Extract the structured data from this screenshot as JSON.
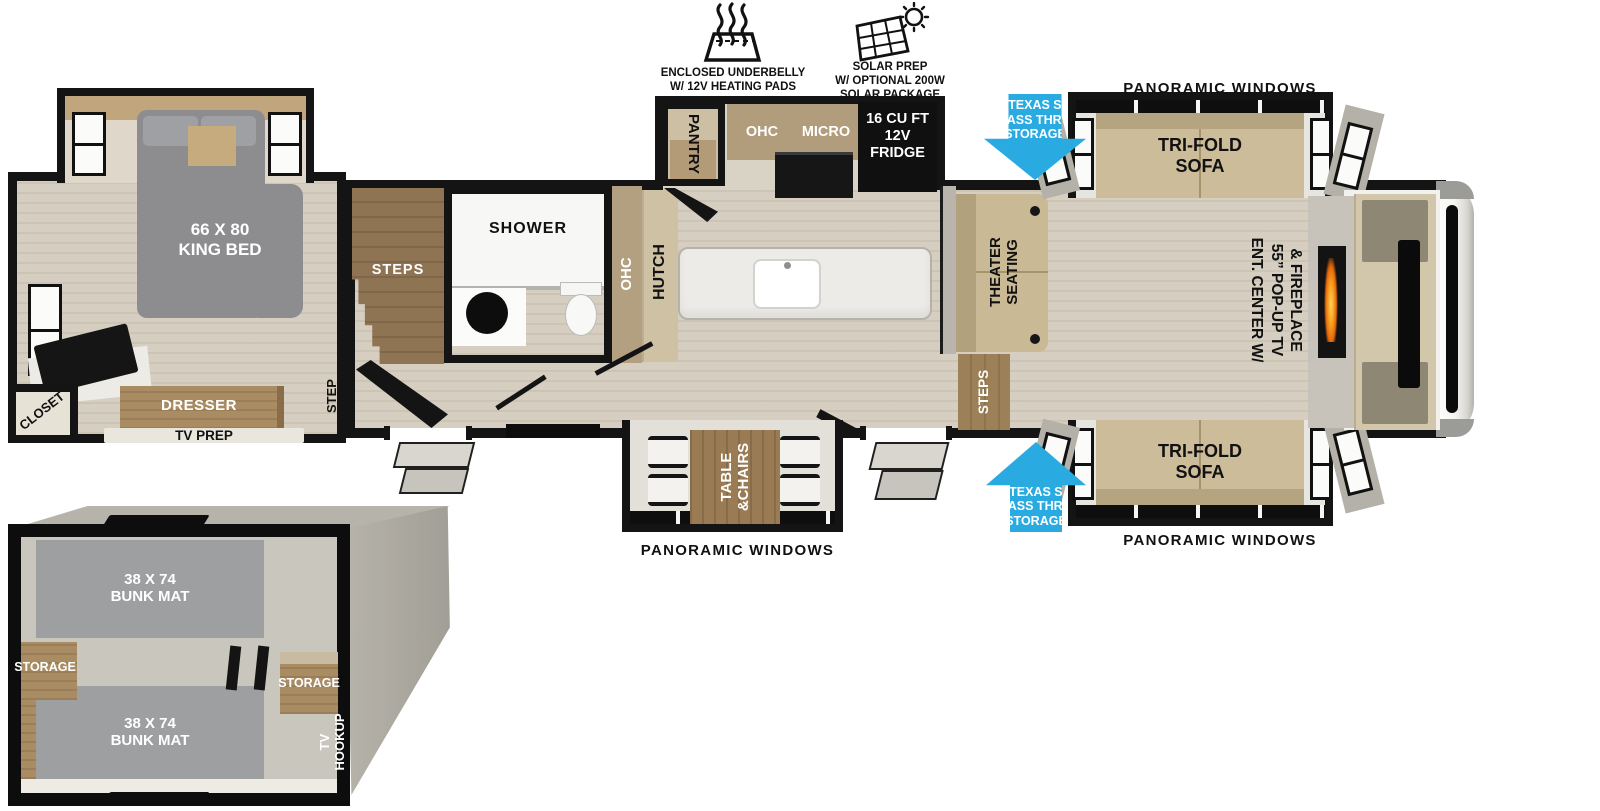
{
  "features": {
    "underbelly": {
      "line1": "ENCLOSED UNDERBELLY",
      "line2": "W/ 12V HEATING PADS"
    },
    "solar": {
      "line1": "SOLAR PREP",
      "line2": "W/ OPTIONAL 200W",
      "line3": "SOLAR PACKAGE"
    }
  },
  "windows": {
    "top": "PANORAMIC WINDOWS",
    "bottom_right": "PANORAMIC WINDOWS",
    "bottom_center": "PANORAMIC WINDOWS"
  },
  "pass_thru": {
    "line1": "XL TEXAS SIZE",
    "line2": "PASS THRU",
    "line3": "STORAGE"
  },
  "bedroom": {
    "bed_line1": "66 X 80",
    "bed_line2": "KING BED",
    "closet": "CLOSET",
    "dresser": "DRESSER",
    "tv_prep": "TV PREP",
    "step": "STEP",
    "steps": "STEPS"
  },
  "bathroom": {
    "shower": "SHOWER",
    "ohc": "OHC"
  },
  "kitchen": {
    "pantry": "PANTRY",
    "ohc": "OHC",
    "micro": "MICRO",
    "hutch": "HUTCH",
    "fridge_line1": "16 CU FT",
    "fridge_line2": "12V",
    "fridge_line3": "FRIDGE"
  },
  "living": {
    "theater_line1": "THEATER",
    "theater_line2": "SEATING",
    "steps": "STEPS",
    "sofa_line1": "TRI-FOLD",
    "sofa_line2": "SOFA",
    "ent_line1": "ENT. CENTER W/",
    "ent_line2": "55” POP-UP TV",
    "ent_line3": "& FIREPLACE"
  },
  "dinette": {
    "line1": "TABLE",
    "line2": "&CHAIRS"
  },
  "bunkroom": {
    "bunk_line1": "38 X 74",
    "bunk_line2": "BUNK MAT",
    "storage": "STORAGE",
    "tv_line1": "TV",
    "tv_line2": "HOOKUP"
  },
  "colors": {
    "arrow_blue": "#29abe2",
    "wall_black": "#141414",
    "floor_tan": "#d6cfc1",
    "cabinet_tan": "#b19c7c",
    "sofa_tan": "#ccbc99",
    "wood_brown": "#9a7b54",
    "bed_gray": "#8d8d8f",
    "mat_gray": "#9e9fa1",
    "flame_orange": "#f79a1c"
  }
}
